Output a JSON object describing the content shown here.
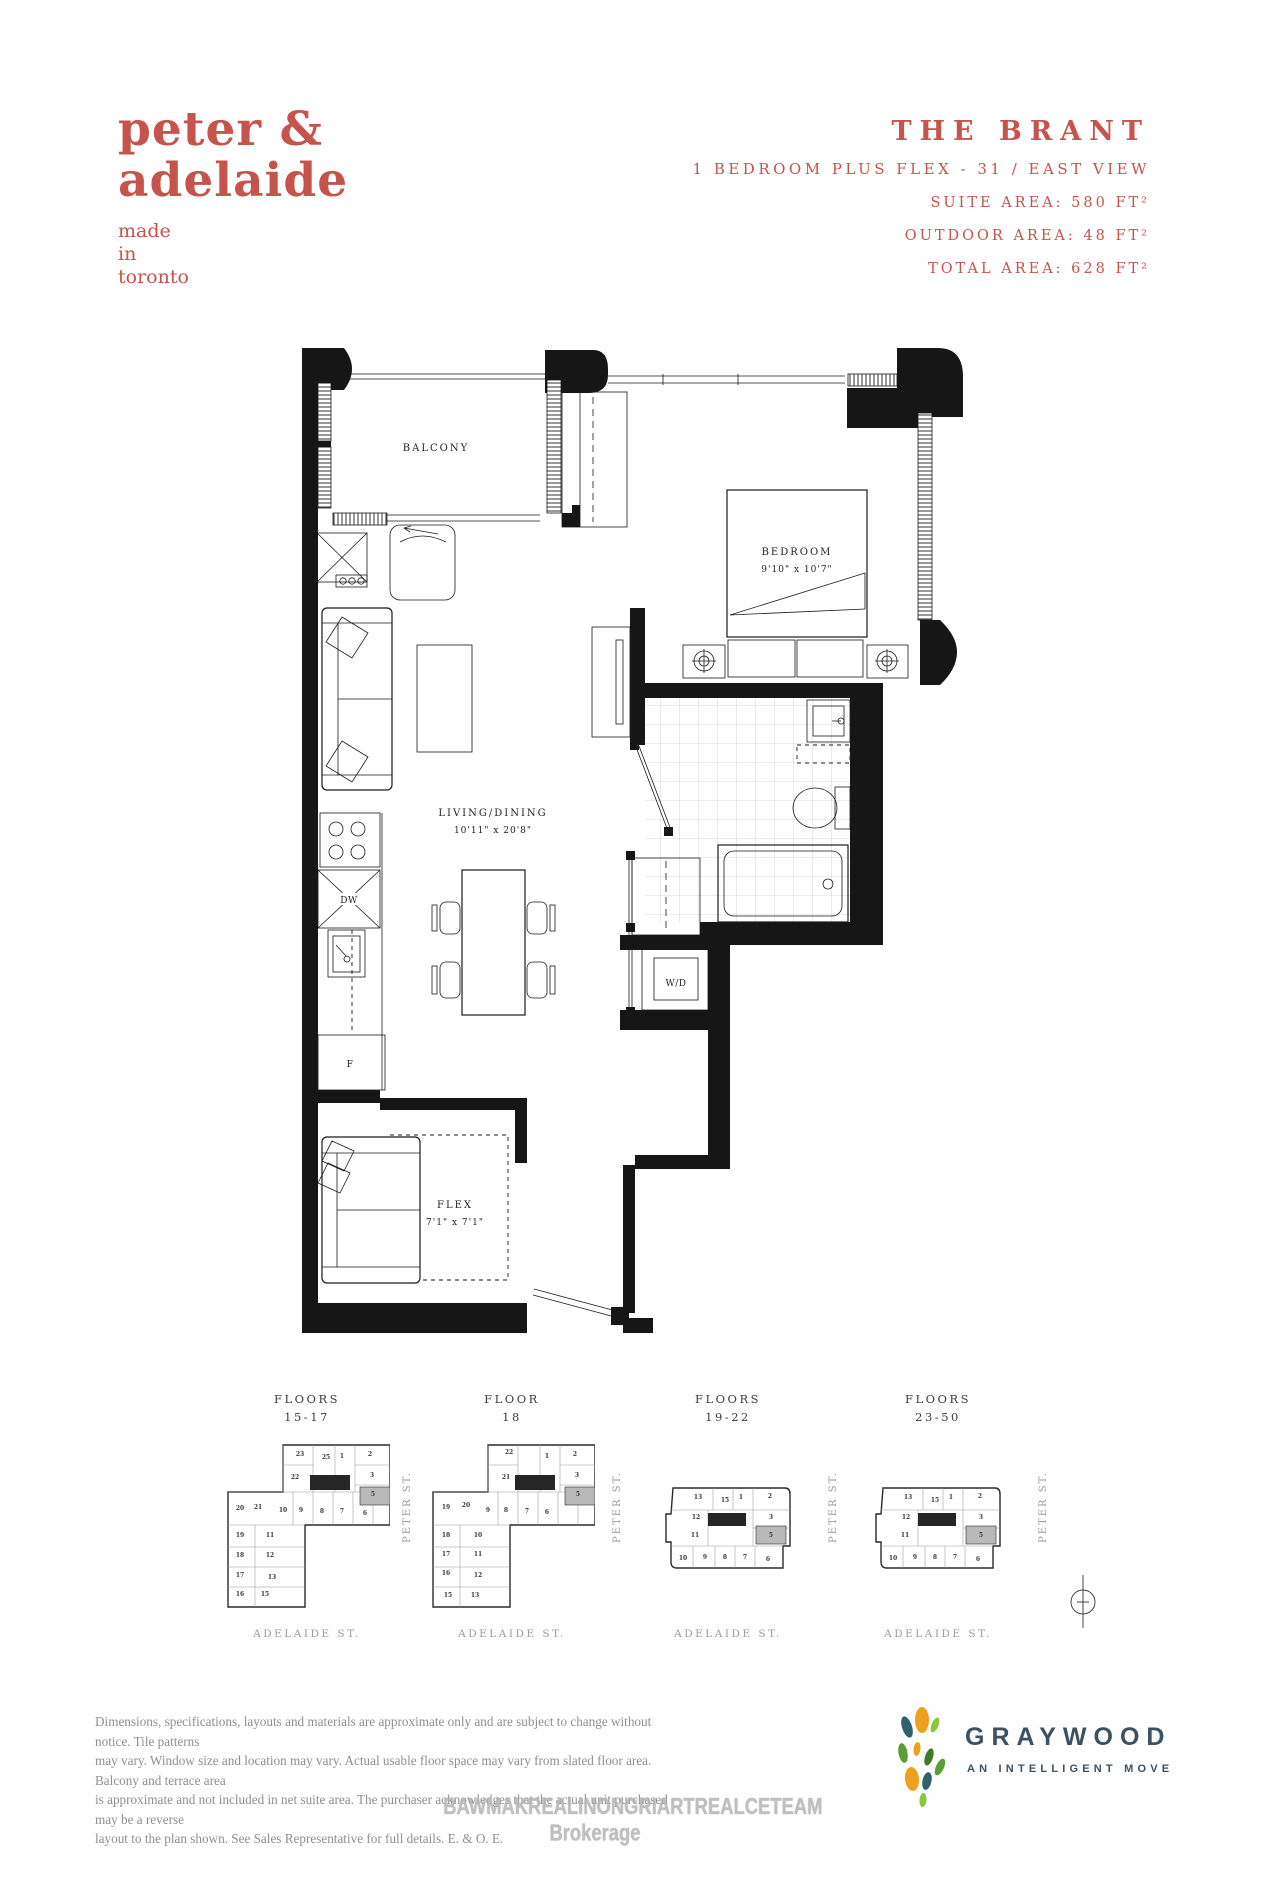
{
  "brand": {
    "name_line1": "peter &",
    "name_line2": "adelaide",
    "tagline_lines": [
      "made",
      "in",
      "toronto"
    ]
  },
  "header": {
    "title": "THE BRANT",
    "subtitle": "1 BEDROOM PLUS FLEX - 31 / EAST VIEW",
    "area_lines": [
      "SUITE AREA: 580 FT²",
      "OUTDOOR AREA: 48 FT²",
      "TOTAL AREA: 628 FT²"
    ]
  },
  "floorplan": {
    "balcony_label": "BALCONY",
    "bedroom_label": "BEDROOM",
    "bedroom_dims": "9'10\" x 10'7\"",
    "living_label": "LIVING/DINING",
    "living_dims": "10'11\" x 20'8\"",
    "flex_label": "FLEX",
    "flex_dims": "7'1\" x 7'1\"",
    "wd_label": "W/D",
    "fridge_label": "F",
    "dishwasher_label": "DW"
  },
  "keyplans": [
    {
      "title_line1": "FLOORS",
      "title_line2": "15-17",
      "peter_street": "PETER ST.",
      "adelaide_street": "ADELAIDE ST.",
      "highlighted_unit": "5",
      "units": [
        {
          "n": "23",
          "x": 75,
          "y": 17
        },
        {
          "n": "25",
          "x": 101,
          "y": 20
        },
        {
          "n": "1",
          "x": 117,
          "y": 19
        },
        {
          "n": "2",
          "x": 145,
          "y": 17
        },
        {
          "n": "22",
          "x": 70,
          "y": 40
        },
        {
          "n": "3",
          "x": 147,
          "y": 38
        },
        {
          "n": "5",
          "x": 148,
          "y": 57
        },
        {
          "n": "20",
          "x": 15,
          "y": 71
        },
        {
          "n": "21",
          "x": 33,
          "y": 70
        },
        {
          "n": "10",
          "x": 58,
          "y": 73
        },
        {
          "n": "9",
          "x": 76,
          "y": 73
        },
        {
          "n": "8",
          "x": 97,
          "y": 74
        },
        {
          "n": "7",
          "x": 117,
          "y": 74
        },
        {
          "n": "6",
          "x": 140,
          "y": 76
        },
        {
          "n": "19",
          "x": 15,
          "y": 98
        },
        {
          "n": "11",
          "x": 45,
          "y": 98
        },
        {
          "n": "18",
          "x": 15,
          "y": 118
        },
        {
          "n": "12",
          "x": 45,
          "y": 118
        },
        {
          "n": "17",
          "x": 15,
          "y": 138
        },
        {
          "n": "13",
          "x": 47,
          "y": 140
        },
        {
          "n": "16",
          "x": 15,
          "y": 157
        },
        {
          "n": "15",
          "x": 40,
          "y": 157
        }
      ]
    },
    {
      "title_line1": "FLOOR",
      "title_line2": "18",
      "peter_street": "PETER ST.",
      "adelaide_street": "ADELAIDE ST.",
      "highlighted_unit": "5",
      "units": [
        {
          "n": "22",
          "x": 79,
          "y": 15
        },
        {
          "n": "1",
          "x": 117,
          "y": 19
        },
        {
          "n": "2",
          "x": 145,
          "y": 17
        },
        {
          "n": "21",
          "x": 76,
          "y": 40
        },
        {
          "n": "3",
          "x": 147,
          "y": 38
        },
        {
          "n": "5",
          "x": 148,
          "y": 57
        },
        {
          "n": "19",
          "x": 16,
          "y": 70
        },
        {
          "n": "20",
          "x": 36,
          "y": 68
        },
        {
          "n": "9",
          "x": 58,
          "y": 73
        },
        {
          "n": "8",
          "x": 76,
          "y": 73
        },
        {
          "n": "7",
          "x": 97,
          "y": 74
        },
        {
          "n": "6",
          "x": 117,
          "y": 75
        },
        {
          "n": "18",
          "x": 16,
          "y": 98
        },
        {
          "n": "10",
          "x": 48,
          "y": 98
        },
        {
          "n": "17",
          "x": 16,
          "y": 117
        },
        {
          "n": "11",
          "x": 48,
          "y": 117
        },
        {
          "n": "16",
          "x": 16,
          "y": 136
        },
        {
          "n": "12",
          "x": 48,
          "y": 138
        },
        {
          "n": "15",
          "x": 18,
          "y": 158
        },
        {
          "n": "13",
          "x": 45,
          "y": 158
        }
      ]
    },
    {
      "title_line1": "FLOORS",
      "title_line2": "19-22",
      "peter_street": "PETER ST.",
      "adelaide_street": "ADELAIDE ST.",
      "highlighted_unit": "5",
      "units": [
        {
          "n": "13",
          "x": 35,
          "y": 17
        },
        {
          "n": "15",
          "x": 62,
          "y": 20
        },
        {
          "n": "1",
          "x": 78,
          "y": 17
        },
        {
          "n": "2",
          "x": 107,
          "y": 16
        },
        {
          "n": "12",
          "x": 33,
          "y": 37
        },
        {
          "n": "3",
          "x": 108,
          "y": 37
        },
        {
          "n": "11",
          "x": 32,
          "y": 55
        },
        {
          "n": "5",
          "x": 108,
          "y": 55
        },
        {
          "n": "10",
          "x": 20,
          "y": 78
        },
        {
          "n": "9",
          "x": 42,
          "y": 77
        },
        {
          "n": "8",
          "x": 62,
          "y": 77
        },
        {
          "n": "7",
          "x": 82,
          "y": 77
        },
        {
          "n": "6",
          "x": 105,
          "y": 79
        }
      ]
    },
    {
      "title_line1": "FLOORS",
      "title_line2": "23-50",
      "peter_street": "PETER ST.",
      "adelaide_street": "ADELAIDE ST.",
      "highlighted_unit": "5",
      "units": [
        {
          "n": "13",
          "x": 35,
          "y": 17
        },
        {
          "n": "15",
          "x": 62,
          "y": 20
        },
        {
          "n": "1",
          "x": 78,
          "y": 17
        },
        {
          "n": "2",
          "x": 107,
          "y": 16
        },
        {
          "n": "12",
          "x": 33,
          "y": 37
        },
        {
          "n": "3",
          "x": 108,
          "y": 37
        },
        {
          "n": "11",
          "x": 32,
          "y": 55
        },
        {
          "n": "5",
          "x": 108,
          "y": 55
        },
        {
          "n": "10",
          "x": 20,
          "y": 78
        },
        {
          "n": "9",
          "x": 42,
          "y": 77
        },
        {
          "n": "8",
          "x": 62,
          "y": 77
        },
        {
          "n": "7",
          "x": 82,
          "y": 77
        },
        {
          "n": "6",
          "x": 105,
          "y": 79
        }
      ]
    }
  ],
  "footer": {
    "disclaimer_lines": [
      "Dimensions, specifications, layouts and materials are approximate only and are subject to change without notice. Tile patterns",
      "may vary. Window size and location may vary. Actual usable floor space may vary from slated floor area. Balcony and terrace area",
      "is approximate and not included in net suite area. The purchaser acknowledges that the actual unit purchased may be a reverse",
      "layout to the plan shown.  See Sales Representative for full details. E. & O. E."
    ],
    "watermark": "BAWMAKREALINONGRIARTREALCETEAM Brokerage"
  },
  "graywood": {
    "wordmark": "GRAYWOOD",
    "tagline": "AN INTELLIGENT MOVE"
  },
  "colors": {
    "accent_red": "#c5544c",
    "keyplan_highlight": "#b9b9b9",
    "graywood_slate": "#3c5161",
    "leaf_orange": "#eea11f",
    "leaf_teal": "#30626b",
    "leaf_green": "#5c9e35",
    "leaf_lime": "#8cc63f",
    "leaf_dark_green": "#417b28"
  }
}
